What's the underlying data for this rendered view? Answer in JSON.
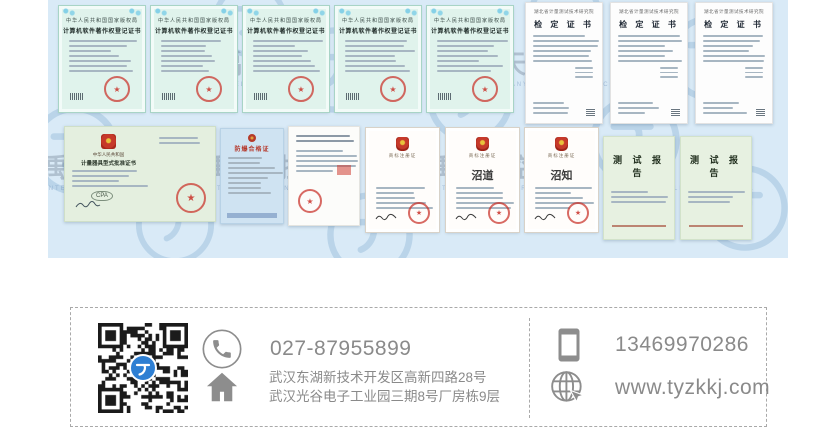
{
  "brand": {
    "watermark_text": "天禹智控",
    "watermark_caption": "TIANYU INTELLIGENT CONTROL"
  },
  "certificates": {
    "copyright": {
      "authority": "中华人民共和国国家版权局",
      "title": "计算机软件著作权登记证书"
    },
    "verification": {
      "issuer": "湖北省计量测试技术研究院",
      "title": "检 定 证 书"
    },
    "type_approval": {
      "country": "中华人民共和国",
      "title": "计量器具型式批准证书"
    },
    "explosion_proof": {
      "title": "防爆合格证"
    },
    "trademark": {
      "title": "商标注册证",
      "marks": [
        "",
        "沼道",
        "沼知"
      ]
    },
    "test_report": {
      "title": "测 试 报 告"
    }
  },
  "contact": {
    "phone": "027-87955899",
    "mobile": "13469970286",
    "address_line1": "武汉东湖新技术开发区高新四路28号",
    "address_line2": "武汉光谷电子工业园三期8号厂房栋9层",
    "website": "www.tyzkkj.com"
  },
  "colors": {
    "accent_blue": "#2e7fd3",
    "collage_bg": "#d9eaf7",
    "seal_red": "#c9302a"
  }
}
